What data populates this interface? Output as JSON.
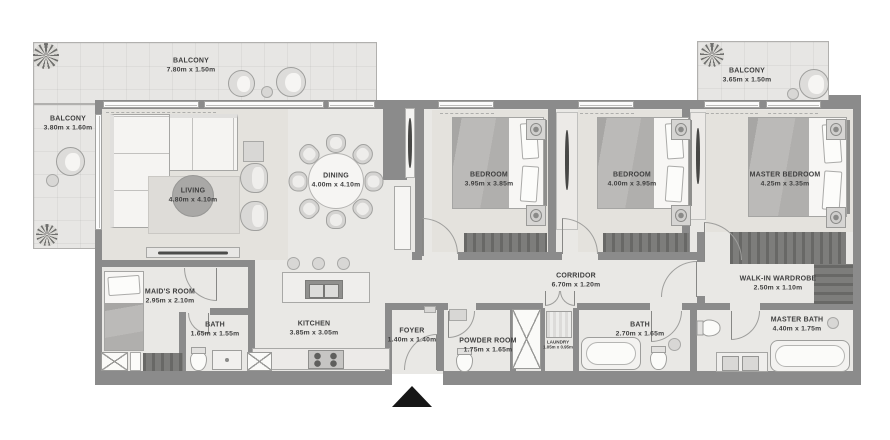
{
  "plan": {
    "rooms": [
      {
        "id": "balcony-top-left",
        "name": "BALCONY",
        "dims": "7.80m x 1.50m"
      },
      {
        "id": "balcony-left",
        "name": "BALCONY",
        "dims": "3.80m x 1.60m"
      },
      {
        "id": "balcony-top-right",
        "name": "BALCONY",
        "dims": "3.65m x 1.50m"
      },
      {
        "id": "living",
        "name": "LIVING",
        "dims": "4.80m x 4.10m"
      },
      {
        "id": "dining",
        "name": "DINING",
        "dims": "4.00m x 4.10m"
      },
      {
        "id": "bedroom-1",
        "name": "BEDROOM",
        "dims": "3.95m x 3.85m"
      },
      {
        "id": "bedroom-2",
        "name": "BEDROOM",
        "dims": "4.00m x 3.95m"
      },
      {
        "id": "master-bedroom",
        "name": "MASTER BEDROOM",
        "dims": "4.25m x 3.35m"
      },
      {
        "id": "maids-room",
        "name": "MAID'S ROOM",
        "dims": "2.95m x 2.10m"
      },
      {
        "id": "bath-1",
        "name": "BATH",
        "dims": "1.65m x 1.55m"
      },
      {
        "id": "kitchen",
        "name": "KITCHEN",
        "dims": "3.85m x 3.05m"
      },
      {
        "id": "foyer",
        "name": "FOYER",
        "dims": "1.40m x 1.40m"
      },
      {
        "id": "powder-room",
        "name": "POWDER ROOM",
        "dims": "1.75m x 1.65m"
      },
      {
        "id": "laundry",
        "name": "LAUNDRY",
        "dims": "1.05m x 0.95m"
      },
      {
        "id": "corridor",
        "name": "CORRIDOR",
        "dims": "6.70m x 1.20m"
      },
      {
        "id": "bath-2",
        "name": "BATH",
        "dims": "2.70m x 1.65m"
      },
      {
        "id": "walk-in-wardrobe",
        "name": "WALK-IN WARDROBE",
        "dims": "2.50m x 1.10m"
      },
      {
        "id": "master-bath",
        "name": "MASTER BATH",
        "dims": "4.40m x 1.75m"
      }
    ],
    "colors": {
      "wall": "#8b8b8b",
      "floor": "#e9e8e5",
      "balcony_floor": "#e7e6e4",
      "dark_wood": "#6e6e6c",
      "label_text": "#3e3e3e",
      "entrance_marker": "#161616"
    },
    "icons": {
      "entrance": "entrance-arrow-up"
    }
  }
}
